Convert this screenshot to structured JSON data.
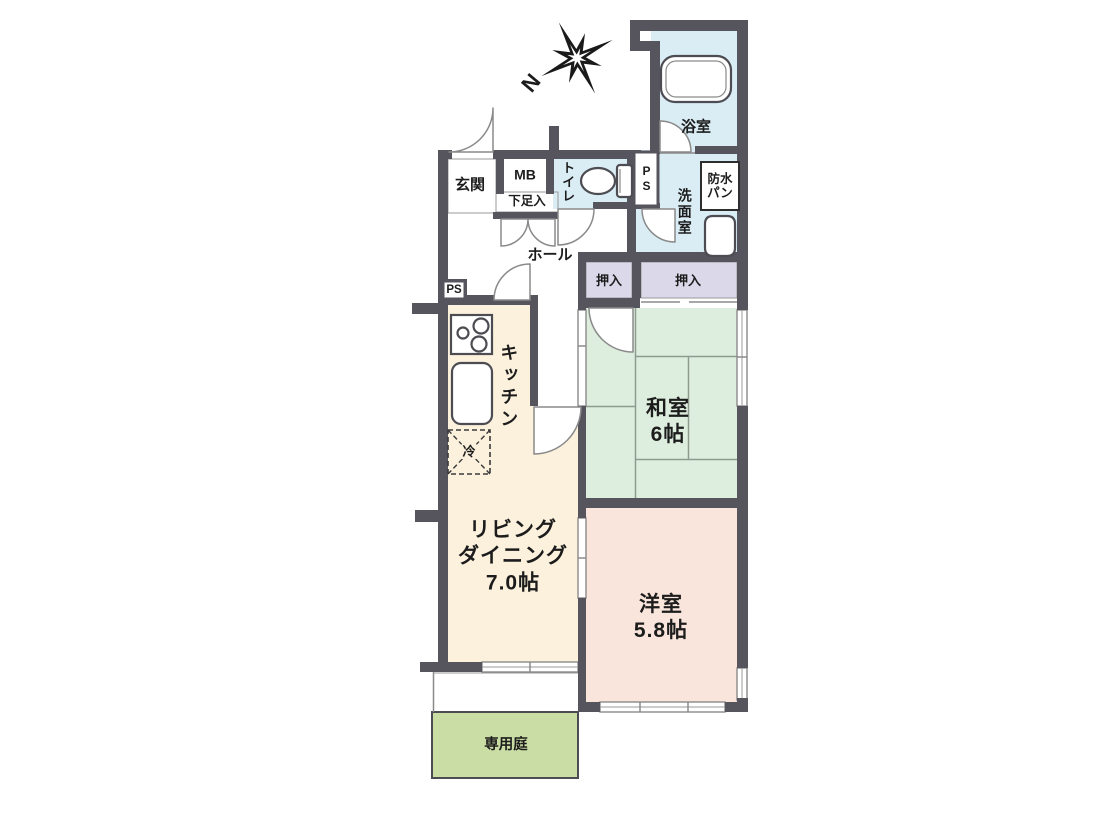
{
  "compass": {
    "label": "N"
  },
  "rooms": {
    "entrance": {
      "label": "玄関"
    },
    "meter_box": {
      "label": "MB"
    },
    "shoe_cabinet": {
      "label": "下足入"
    },
    "toilet": {
      "label": "トイレ"
    },
    "pipe_space_upper": {
      "label": "PS"
    },
    "bathroom": {
      "label": "浴室"
    },
    "waterproof_pan": {
      "line1": "防水",
      "line2": "パン"
    },
    "washroom": {
      "label": "洗面室"
    },
    "hall": {
      "label": "ホール"
    },
    "pipe_space_lower": {
      "label": "PS"
    },
    "kitchen": {
      "label": "キッチン"
    },
    "refrigerator": {
      "label": "冷"
    },
    "closet_left": {
      "label": "押入"
    },
    "closet_right": {
      "label": "押入"
    },
    "japanese_room": {
      "name": "和室",
      "size": "6帖"
    },
    "living_dining": {
      "name_line1": "リビング",
      "name_line2": "ダイニング",
      "size": "7.0帖"
    },
    "western_room": {
      "name": "洋室",
      "size": "5.8帖"
    },
    "private_garden": {
      "label": "専用庭"
    }
  },
  "palette": {
    "wall": "#56555d",
    "water_rooms": "#daedf5",
    "storage": "#dbd8ea",
    "wood_rooms": "#fbf1dc",
    "tatami_room": "#deeede",
    "bedroom": "#fae5dc",
    "garden": "#c9dda5",
    "line": "#8a8a8a",
    "text": "#1c1c1c"
  }
}
